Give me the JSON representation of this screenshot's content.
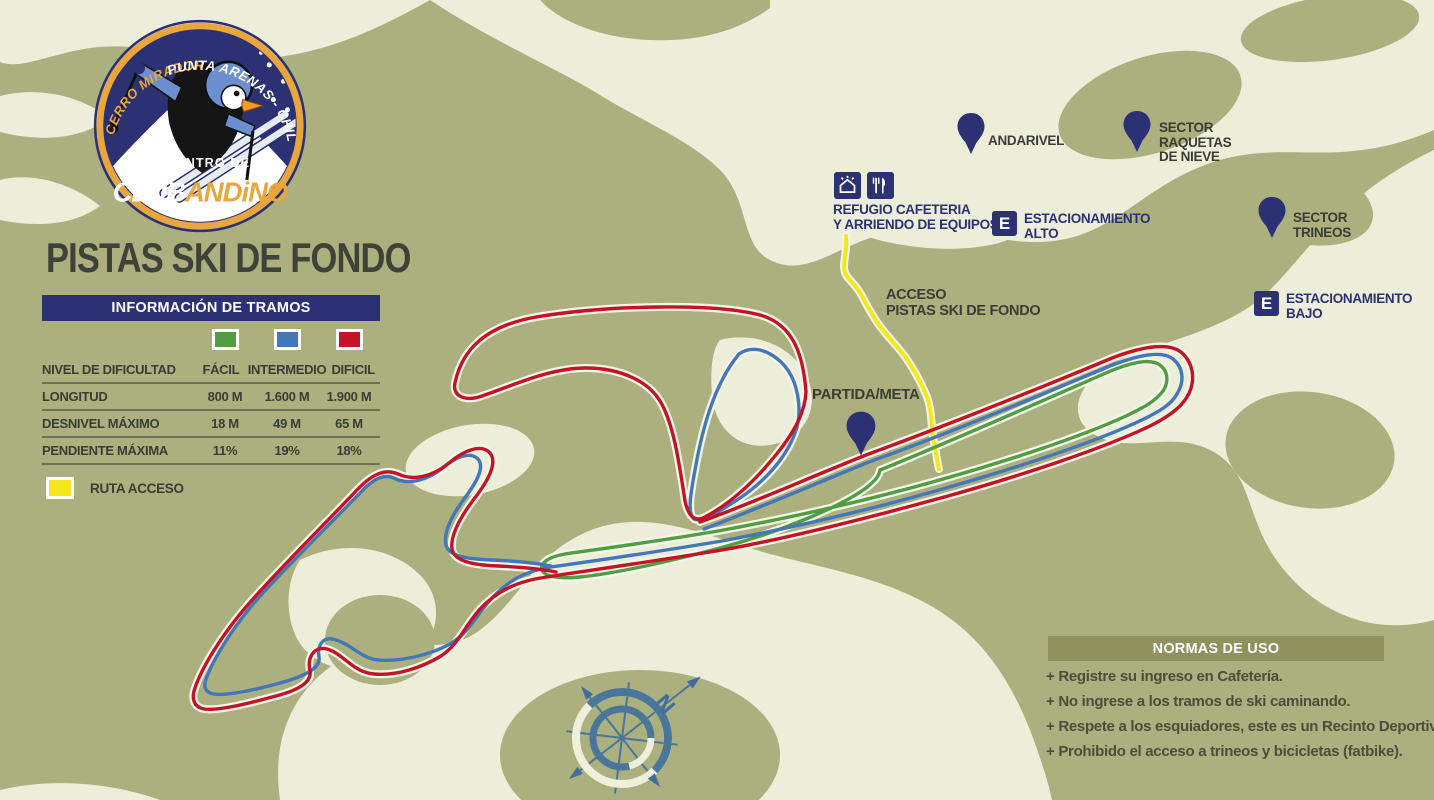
{
  "colors": {
    "background_olive": "#abb07e",
    "terrain_cream": "#edeeda",
    "navy": "#2b3173",
    "orange": "#e9a63c",
    "trail_red": "#c41325",
    "trail_blue": "#4377b8",
    "trail_green": "#519d43",
    "route_yellow": "#f6e71c",
    "trail_casing": "#f4f4e8",
    "compass_blue": "#4a7699",
    "label_dark": "#3a3d33",
    "normas_bar": "#8f915f"
  },
  "logo": {
    "arc_left": "CERRO MIRADOR",
    "arc_right": "PUNTA ARENAS - CHILE",
    "line_small": "CENTRO DE SKI",
    "club": "CLUB",
    "andino": "ANDiNO"
  },
  "title": "PISTAS SKI DE FONDO",
  "info_table": {
    "header": "INFORMACIÓN DE TRAMOS",
    "rows": [
      {
        "label": "NIVEL DE DIFICULTAD",
        "values": [
          "FÁCIL",
          "INTERMEDIO",
          "DIFICIL"
        ]
      },
      {
        "label": "LONGITUD",
        "values": [
          "800 M",
          "1.600 M",
          "1.900 M"
        ]
      },
      {
        "label": "DESNIVEL MÁXIMO",
        "values": [
          "18 M",
          "49 M",
          "65 M"
        ]
      },
      {
        "label": "PENDIENTE MÁXIMA",
        "values": [
          "11%",
          "19%",
          "18%"
        ]
      }
    ]
  },
  "legend_access": {
    "label": "RUTA ACCESO"
  },
  "markers": {
    "andarivel": {
      "label": "ANDARIVEL"
    },
    "sector_raquetas": {
      "line1": "SECTOR",
      "line2": "RAQUETAS",
      "line3": "DE NIEVE"
    },
    "sector_trineos": {
      "line1": "SECTOR",
      "line2": "TRINEOS"
    },
    "refugio": {
      "line1": "REFUGIO CAFETERIA",
      "line2": "Y ARRIENDO DE EQUIPOS"
    },
    "estacionamiento_alto": {
      "badge": "E",
      "line1": "ESTACIONAMIENTO",
      "line2": "ALTO"
    },
    "estacionamiento_bajo": {
      "badge": "E",
      "line1": "ESTACIONAMIENTO",
      "line2": "BAJO"
    },
    "acceso": {
      "line1": "ACCESO",
      "line2": "PISTAS SKI DE FONDO"
    },
    "partida": {
      "label": "PARTIDA/META"
    }
  },
  "normas": {
    "header": "NORMAS DE USO",
    "rules": [
      "+ Registre su ingreso en Cafetería.",
      "+ No ingrese a los tramos de ski caminando.",
      "+ Respete a los esquiadores, este es un Recinto Deportivo.",
      "+ Prohibido el acceso a trineos y bicicletas (fatbike)."
    ]
  },
  "compass": {
    "north_label": "N"
  }
}
